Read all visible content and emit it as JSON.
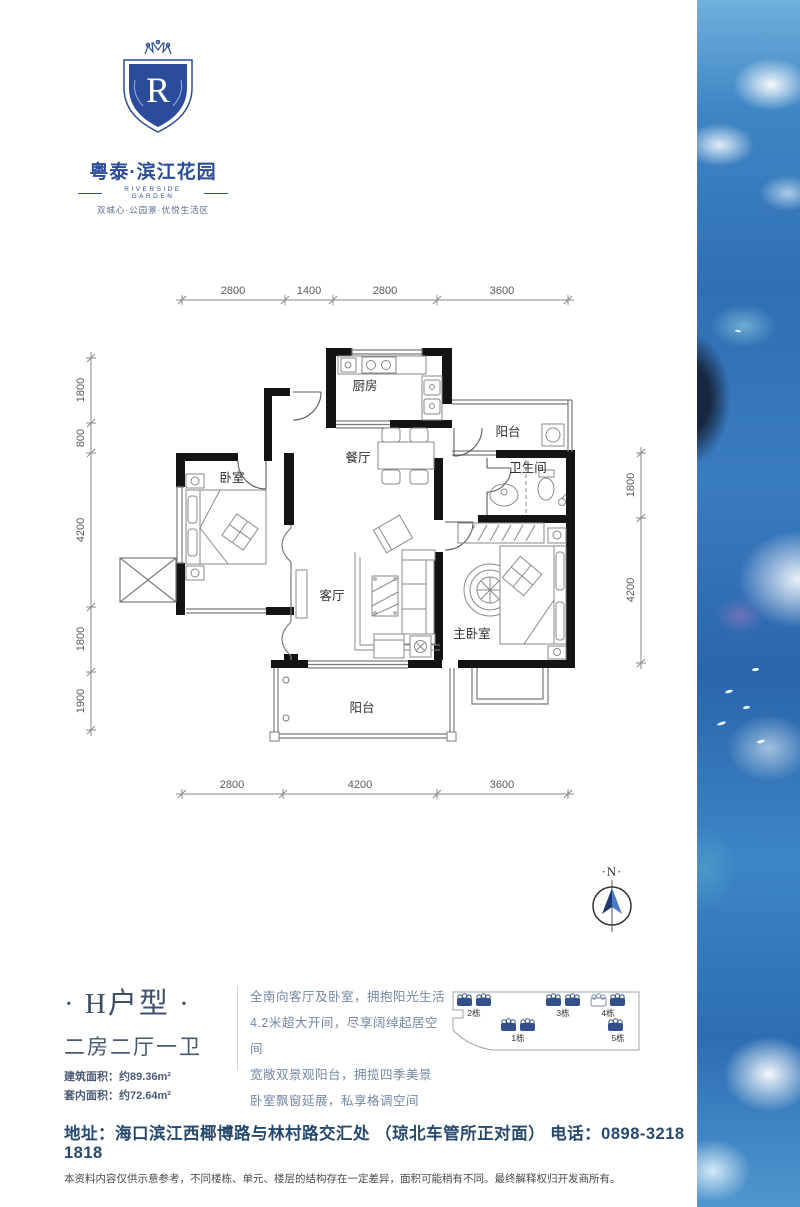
{
  "theme": {
    "brand_blue": "#2b4c9b",
    "heading_color": "#3e5069",
    "body_text_color": "#7488a6",
    "address_color": "#27496f",
    "wall_color": "#141414",
    "ocean_blue": "#2f6fb4"
  },
  "brand": {
    "monogram": "R",
    "name_cn": "粤泰·滨江花园",
    "name_en": "RIVERSIDE GARDEN",
    "tagline": "双城心·公园景·优悦生活区"
  },
  "floorplan": {
    "rooms": {
      "kitchen": "厨房",
      "balcony_top": "阳台",
      "dining": "餐厅",
      "bathroom": "卫生间",
      "bedroom": "卧室",
      "living": "客厅",
      "master": "主卧室",
      "balcony_bottom": "阳台"
    },
    "dims_top": [
      "2800",
      "1400",
      "2800",
      "3600"
    ],
    "dims_bottom": [
      "2800",
      "4200",
      "3600"
    ],
    "dims_left": [
      "1800",
      "800",
      "4200",
      "1800",
      "1900"
    ],
    "dims_right": [
      "1800",
      "4200"
    ]
  },
  "compass": {
    "label": "·N·"
  },
  "unit": {
    "title": "· H户型 ·",
    "layout": "二房二厅一卫",
    "gross_area": "建筑面积：约89.36m²",
    "net_area": "套内面积：约72.64m²"
  },
  "selling_points": [
    "全南向客厅及卧室，拥抱阳光生活",
    "4.2米超大开间，尽享阔绰起居空间",
    "宽敞双景观阳台，拥揽四季美景",
    "卧室飘窗延展，私享格调空间"
  ],
  "siteplan": {
    "buildings": [
      "2栋",
      "3栋",
      "4栋",
      "1栋",
      "5栋"
    ]
  },
  "footer": {
    "address": "地址：海口滨江西椰博路与林村路交汇处 （琼北车管所正对面） 电话：0898-3218 1818",
    "disclaimer": "本资料内容仅供示意参考，不同楼栋、单元、楼层的结构存在一定差异，面积可能稍有不同。最终解释权归开发商所有。"
  }
}
